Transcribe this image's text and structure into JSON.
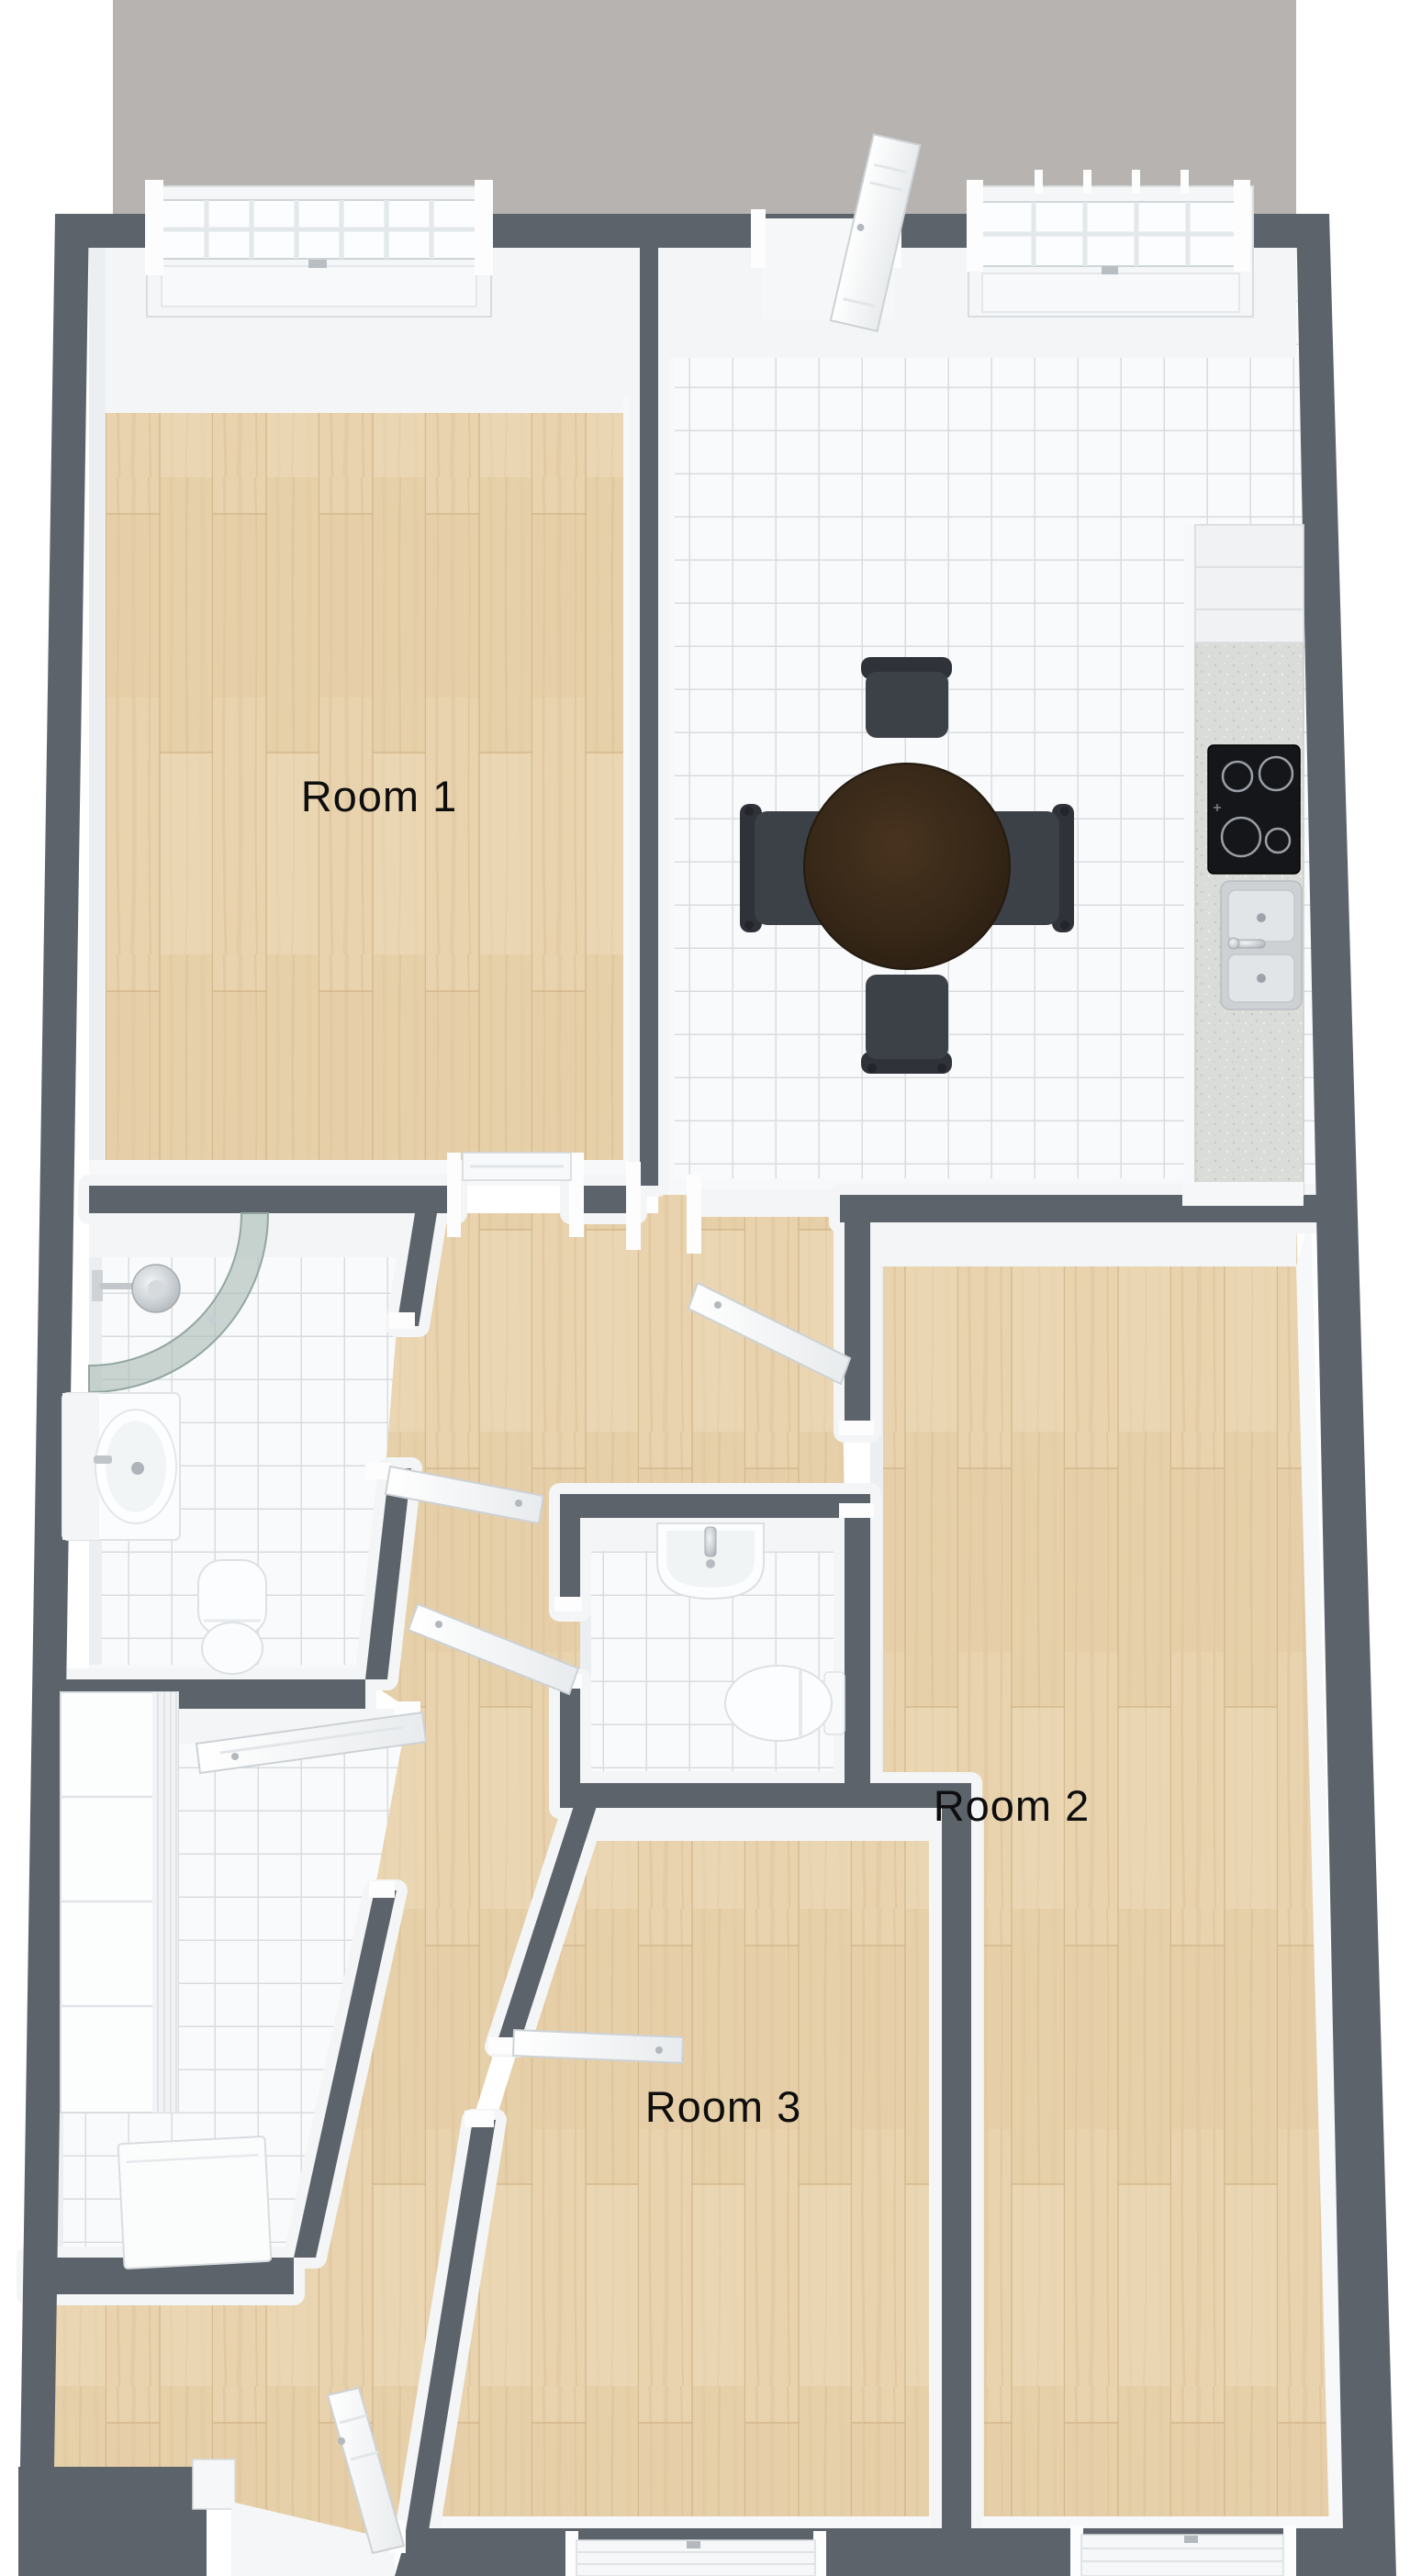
{
  "plan_type": "3d-floor-plan-top-view",
  "labels": {
    "room1": "Room 1",
    "room2": "Room 2",
    "room3": "Room 3"
  },
  "rooms": [
    {
      "name": "Room 1",
      "floor": "wood",
      "features": [
        "top-window"
      ]
    },
    {
      "name": "kitchen-dining",
      "floor": "white-tile",
      "features": [
        "balcony-door",
        "top-window",
        "counter-with-cooktop-and-double-sink",
        "round-dining-table",
        "4-chairs"
      ]
    },
    {
      "name": "Room 2",
      "floor": "wood",
      "features": [
        "bottom-window",
        "open-door"
      ]
    },
    {
      "name": "Room 3",
      "floor": "wood",
      "features": [
        "bottom-window",
        "open-door",
        "angled-left-wall"
      ]
    },
    {
      "name": "bathroom",
      "floor": "white-tile",
      "features": [
        "corner-shower",
        "washbasin",
        "toilet"
      ]
    },
    {
      "name": "wc",
      "floor": "white-tile",
      "features": [
        "washbasin",
        "toilet"
      ]
    },
    {
      "name": "hallway",
      "floor": "wood",
      "features": [
        "angled-walls",
        "entrance-door"
      ]
    },
    {
      "name": "closet",
      "floor": "white-tile",
      "features": [
        "wardrobe",
        "cabinet",
        "open-door"
      ]
    },
    {
      "name": "balcony-terrace",
      "floor": "concrete-gray"
    }
  ],
  "colors": {
    "wall": "#5c636b",
    "balcony": "#b6b3b0",
    "wood_floor": "#e6d0a9",
    "tile_floor": "#f9fafb",
    "tile_line": "#d9dcdf",
    "wall_face_white": "#f3f5f6",
    "counter_granite": "#dadcd9",
    "cooktop": "#15161a",
    "sink_steel": "#cdd1d4",
    "table_wood": "#372818",
    "chair": "#3c4047",
    "shower_glass": "#a9bab4",
    "fixture_white": "#fcfdfe",
    "label_text": "#0e0e0e"
  }
}
